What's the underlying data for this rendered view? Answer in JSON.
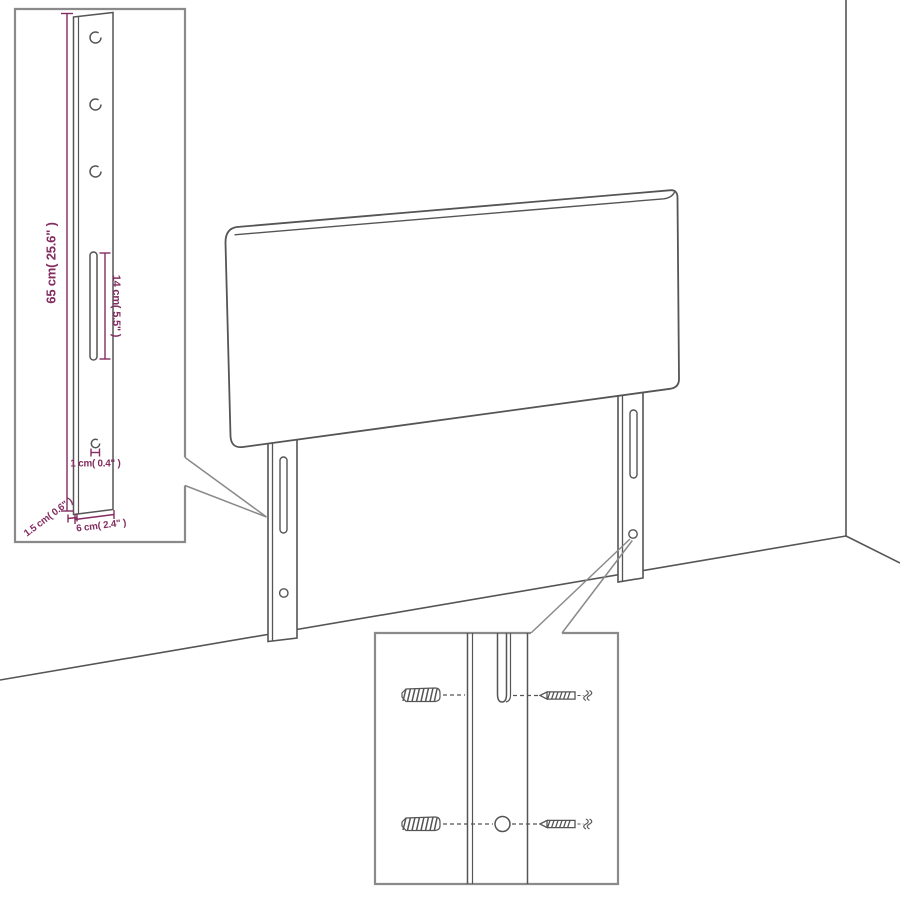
{
  "diagram": {
    "kind": "headboard-assembly-technical-drawing",
    "colors": {
      "line": "#555555",
      "inset_border": "#8a8a8a",
      "dimension": "#832c60",
      "background": "#ffffff"
    },
    "leg_inset": {
      "dimensions": {
        "post_height": "65 cm( 25.6\" )",
        "slot_length": "14 cm( 5.5\" )",
        "hole_diameter": "1 cm( 0.4\" )",
        "post_width": "6 cm( 2.4\" )",
        "post_depth": "1.5 cm( 0.6\" )"
      }
    }
  }
}
